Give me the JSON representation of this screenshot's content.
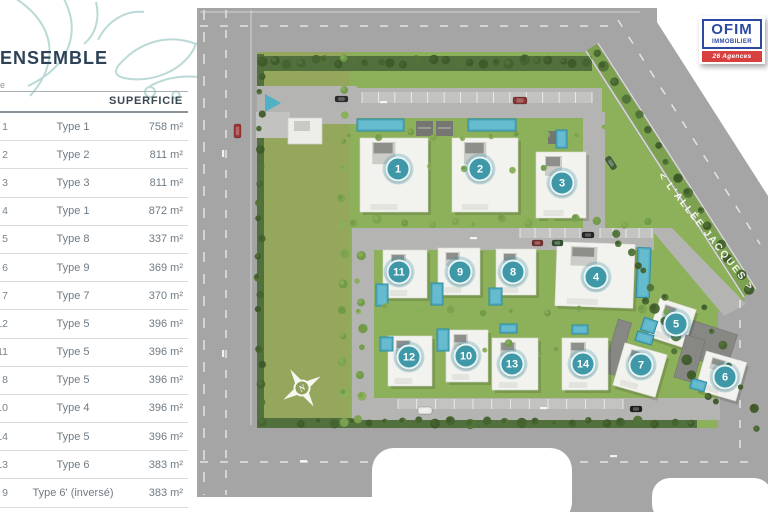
{
  "title": "ENSEMBLE",
  "side_note": "e",
  "table": {
    "header": "SUPERFICIE",
    "rows": [
      {
        "num": "1",
        "type": "Type 1",
        "area": "758 m²"
      },
      {
        "num": "2",
        "type": "Type 2",
        "area": "811 m²"
      },
      {
        "num": "3",
        "type": "Type 3",
        "area": "811 m²"
      },
      {
        "num": "4",
        "type": "Type 1",
        "area": "872 m²"
      },
      {
        "num": "5",
        "type": "Type 8",
        "area": "337 m²"
      },
      {
        "num": "6",
        "type": "Type 9",
        "area": "369 m²"
      },
      {
        "num": "7",
        "type": "Type 7",
        "area": "370 m²"
      },
      {
        "num": "12",
        "type": "Type 5",
        "area": "396 m²"
      },
      {
        "num": "11",
        "type": "Type 5",
        "area": "396 m²"
      },
      {
        "num": "8",
        "type": "Type 5",
        "area": "396 m²"
      },
      {
        "num": "10",
        "type": "Type 4",
        "area": "396 m²"
      },
      {
        "num": "14",
        "type": "Type 5",
        "area": "396 m²"
      },
      {
        "num": "13",
        "type": "Type 6",
        "area": "383 m²"
      },
      {
        "num": "9",
        "type": "Type 6' (inversé)",
        "area": "383 m²"
      }
    ]
  },
  "map": {
    "street_label": "< L'ALLÉE JACQUES >",
    "compass": "N",
    "badges": [
      {
        "num": "1",
        "x": 398,
        "y": 169
      },
      {
        "num": "2",
        "x": 480,
        "y": 169
      },
      {
        "num": "3",
        "x": 562,
        "y": 183
      },
      {
        "num": "4",
        "x": 596,
        "y": 277
      },
      {
        "num": "5",
        "x": 676,
        "y": 324
      },
      {
        "num": "6",
        "x": 725,
        "y": 377
      },
      {
        "num": "7",
        "x": 641,
        "y": 365
      },
      {
        "num": "8",
        "x": 513,
        "y": 272
      },
      {
        "num": "9",
        "x": 460,
        "y": 272
      },
      {
        "num": "10",
        "x": 466,
        "y": 356
      },
      {
        "num": "11",
        "x": 399,
        "y": 272
      },
      {
        "num": "12",
        "x": 409,
        "y": 357
      },
      {
        "num": "13",
        "x": 512,
        "y": 364
      },
      {
        "num": "14",
        "x": 583,
        "y": 364
      }
    ]
  },
  "logo": {
    "brand": "OFIM",
    "subtitle": "IMMOBILIER",
    "banner": "26 Agences"
  },
  "colors": {
    "accent_teal": "#3e98a8",
    "title_navy": "#2d4257",
    "logo_blue": "#2b4aa0",
    "logo_red": "#d84040",
    "pool": "#55b0c6",
    "grass": "#94a75d",
    "road": "#a5a5a5"
  }
}
